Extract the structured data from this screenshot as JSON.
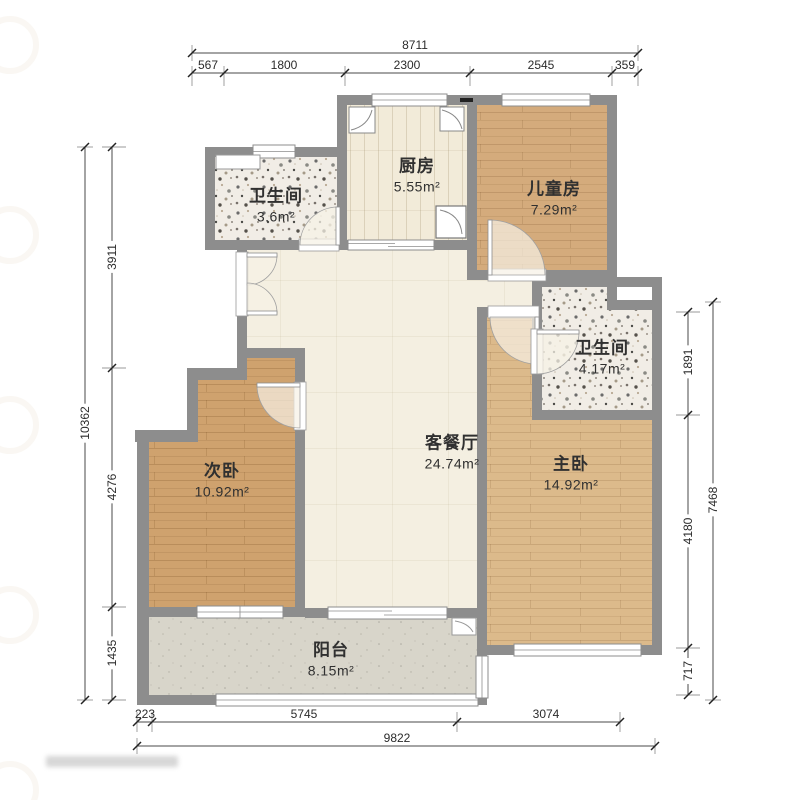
{
  "rooms": {
    "bath_top": {
      "name": "卫生间",
      "area": "3.6m²"
    },
    "kitchen": {
      "name": "厨房",
      "area": "5.55m²"
    },
    "kids": {
      "name": "儿童房",
      "area": "7.29m²"
    },
    "bath_right": {
      "name": "卫生间",
      "area": "4.17m²"
    },
    "living": {
      "name": "客餐厅",
      "area": "24.74m²"
    },
    "second_bed": {
      "name": "次卧",
      "area": "10.92m²"
    },
    "master_bed": {
      "name": "主卧",
      "area": "14.92m²"
    },
    "balcony": {
      "name": "阳台",
      "area": "8.15m²"
    }
  },
  "dimensions": {
    "top": {
      "total": "8711",
      "segments": [
        "567",
        "1800",
        "2300",
        "2545",
        "359"
      ]
    },
    "left": {
      "total": "10362",
      "segments": [
        "3911",
        "4276",
        "1435"
      ]
    },
    "right": {
      "total": "7468",
      "segments": [
        "1891",
        "4180",
        "717"
      ]
    },
    "bottom": {
      "total": "9822",
      "segments": [
        "223",
        "5745",
        "3074"
      ]
    }
  },
  "colors": {
    "wall": "#8d8d8d",
    "wood_kids": "#d4ab7c",
    "wood_master": "#dcba8b",
    "wood_second": "#cfa26e",
    "terrazzo": "#f1ede6",
    "living_floor": "#f4efe1",
    "kitchen_floor": "#f2ebd9",
    "balcony_floor": "#d8d5ca",
    "dim_text": "#2b2b2b"
  }
}
